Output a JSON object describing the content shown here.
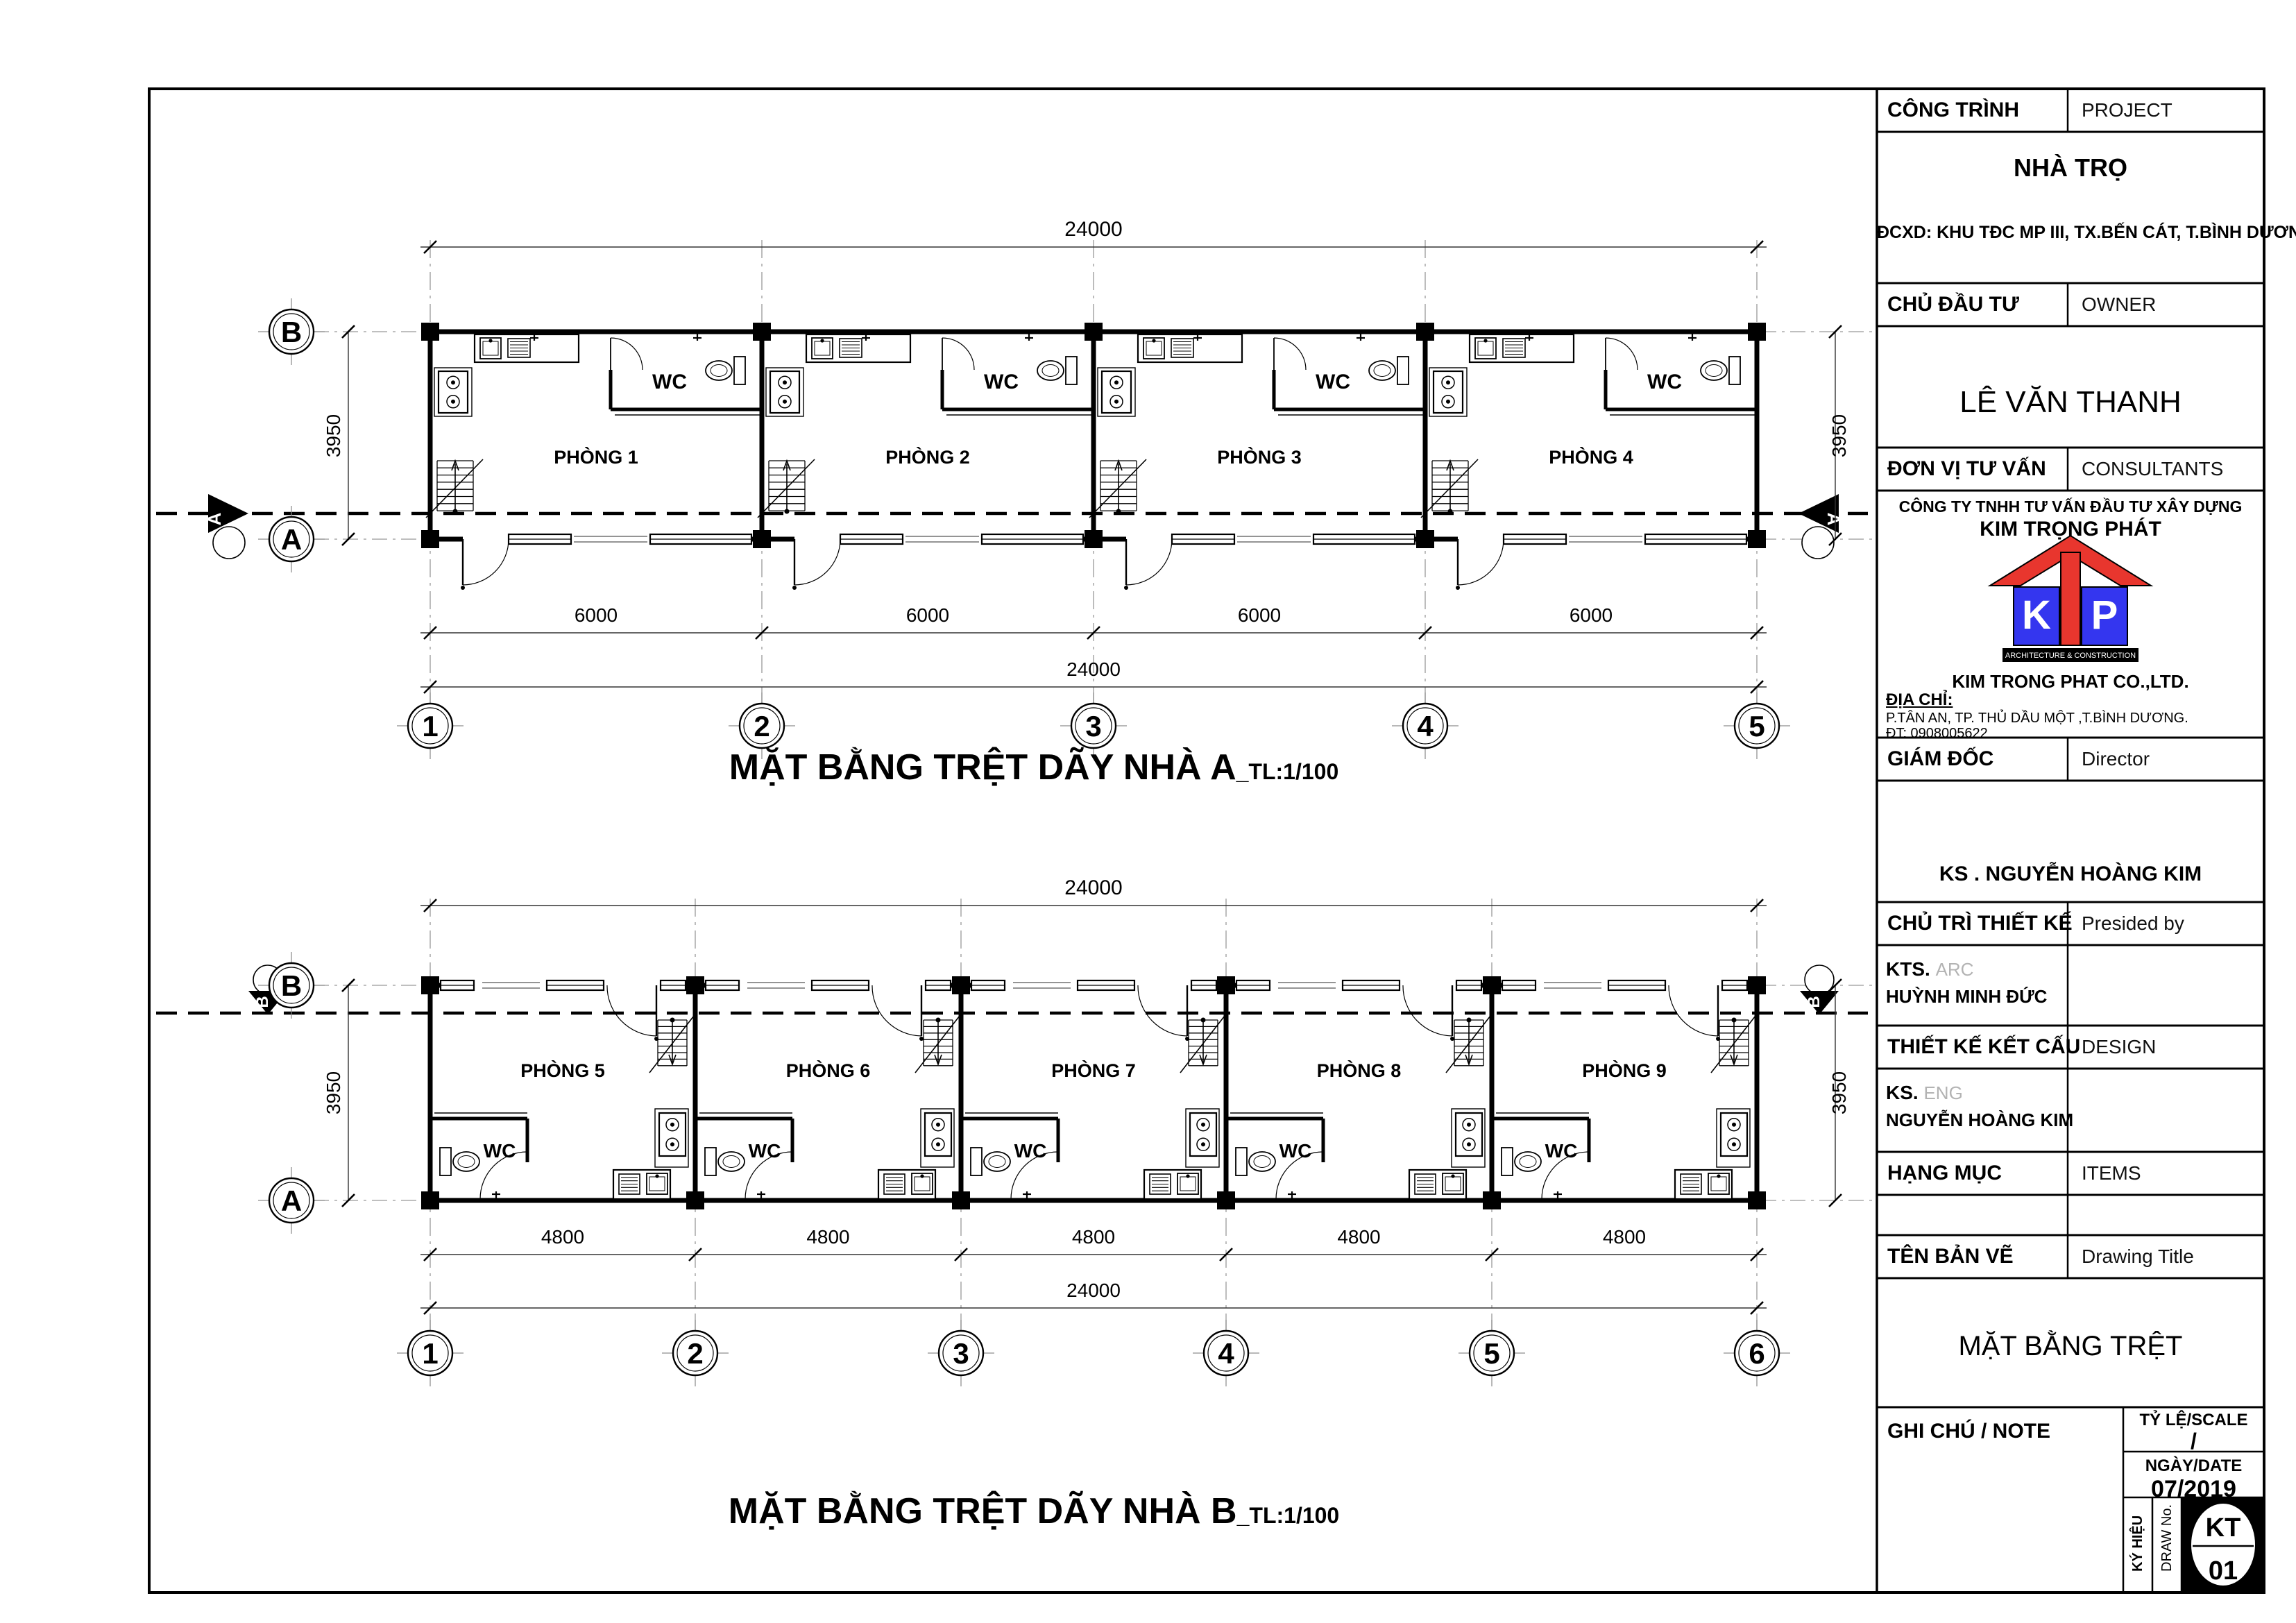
{
  "title_block": {
    "project_label": "CÔNG TRÌNH",
    "project_label_en": "PROJECT",
    "project_name": "NHÀ TRỌ",
    "project_address": "ĐCXD: KHU TĐC MP III, TX.BẾN CÁT, T.BÌNH DƯƠNG.",
    "owner_label": "CHỦ ĐẦU TƯ",
    "owner_label_en": "OWNER",
    "owner_name": "LÊ VĂN THANH",
    "consultant_label": "ĐƠN VỊ TƯ VẤN",
    "consultant_label_en": "CONSULTANTS",
    "consultant_company_line1": "CÔNG TY TNHH TƯ VẤN ĐẦU TƯ XÂY DỰNG",
    "consultant_company_line2": "KIM TRỌNG PHÁT",
    "logo": {
      "letter_k": "K",
      "letter_t": "T",
      "letter_p": "P",
      "tagline": "ARCHITECTURE & CONSTRUCTION",
      "red": "#e8362e",
      "blue": "#3436ef"
    },
    "company_en": "KIM TRONG PHAT CO.,LTD.",
    "address_label": "ĐỊA CHỈ:",
    "address_line": "P.TÂN AN, TP. THỦ DẦU MỘT ,T.BÌNH DƯƠNG.",
    "phone_line": "ĐT: 0908005622",
    "director_label": "GIÁM ĐỐC",
    "director_label_en": "Director",
    "director_name": "KS . NGUYỄN HOÀNG KIM",
    "presided_label": "CHỦ TRÌ THIẾT KẾ",
    "presided_label_en": "Presided  by",
    "architect_prefix": "KTS.",
    "architect_prefix_en": "ARC",
    "architect_name": "HUỲNH MINH ĐỨC",
    "structure_label": "THIẾT KẾ KẾT CẤU",
    "structure_label_en": "DESIGN",
    "engineer_prefix": "KS.",
    "engineer_prefix_en": "ENG",
    "engineer_name": "NGUYỄN HOÀNG KIM",
    "items_label": "HẠNG MỤC",
    "items_label_en": "ITEMS",
    "drawing_title_label": "TÊN BẢN VẼ",
    "drawing_title_label_en": "Drawing  Title",
    "drawing_title": "MẶT BẰNG TRỆT",
    "note_label": "GHI CHÚ / NOTE",
    "scale_label": "TỶ LỆ/SCALE",
    "scale_value": "/",
    "date_label": "NGÀY/DATE",
    "date_value": "07/2019",
    "symbol_label": "KÝ HIỆU",
    "drawno_label": "DRAW  No.",
    "drawing_code": "KT",
    "drawing_number": "01"
  },
  "plan_a": {
    "title": "MẶT BẰNG TRỆT DÃY NHÀ A",
    "title_suffix": "_TL:1/100",
    "rooms": [
      "PHÒNG 1",
      "PHÒNG 2",
      "PHÒNG 3",
      "PHÒNG 4"
    ],
    "wc_label": "WC",
    "dim_total_top": "24000",
    "dim_bays": [
      "6000",
      "6000",
      "6000",
      "6000"
    ],
    "dim_total_bottom": "24000",
    "dim_depth": "3950",
    "grid_cols": [
      "1",
      "2",
      "3",
      "4",
      "5"
    ],
    "grid_row_top": "B",
    "grid_row_bottom": "A",
    "section_mark": "A"
  },
  "plan_b": {
    "title": "MẶT BẰNG TRỆT DÃY NHÀ B",
    "title_suffix": "_TL:1/100",
    "rooms": [
      "PHÒNG 5",
      "PHÒNG 6",
      "PHÒNG 7",
      "PHÒNG 8",
      "PHÒNG 9"
    ],
    "wc_label": "WC",
    "dim_total_top": "24000",
    "dim_bays": [
      "4800",
      "4800",
      "4800",
      "4800",
      "4800"
    ],
    "dim_total_bottom": "24000",
    "dim_depth": "3950",
    "grid_cols": [
      "1",
      "2",
      "3",
      "4",
      "5",
      "6"
    ],
    "grid_row_top": "B",
    "grid_row_bottom": "A",
    "section_mark": "B"
  }
}
